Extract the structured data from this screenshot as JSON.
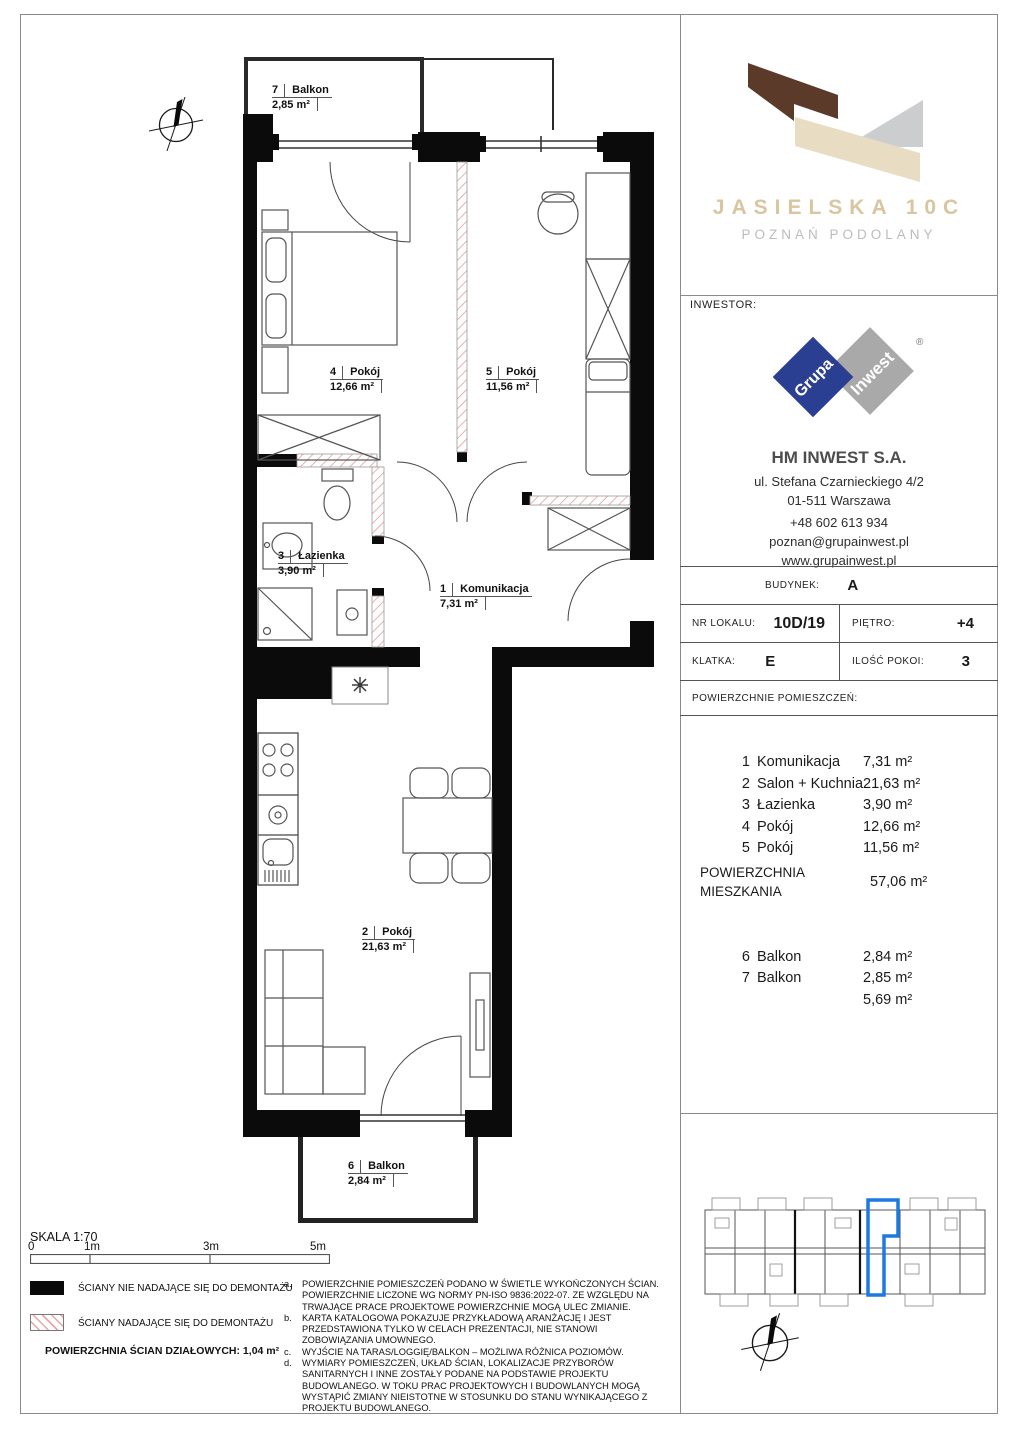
{
  "project": {
    "title": "JASIELSKA 10C",
    "subtitle": "POZNAŃ PODOLANY",
    "colors": {
      "brown": "#5b3a29",
      "beige": "#e8dcc3",
      "gray": "#cccdce",
      "title_beige": "#d9c6a0",
      "highlight_blue": "#1b79e0",
      "hatch_red": "#e89b9b"
    }
  },
  "investor": {
    "label": "INWESTOR:",
    "logo_word_left": "Grupa",
    "logo_word_right": "Inwest",
    "reg_mark": "®",
    "name": "HM INWEST S.A.",
    "address_line1": "ul. Stefana Czarnieckiego 4/2",
    "address_line2": "01-511 Warszawa",
    "phone": "+48 602 613 934",
    "email": "poznan@grupainwest.pl",
    "website": "www.grupainwest.pl"
  },
  "unit_info": {
    "budynek_label": "BUDYNEK:",
    "budynek": "A",
    "nr_lokalu_label": "NR LOKALU:",
    "nr_lokalu": "10D/19",
    "pietro_label": "PIĘTRO:",
    "pietro": "+4",
    "klatka_label": "KLATKA:",
    "klatka": "E",
    "ilosc_pokoi_label": "ILOŚĆ POKOI:",
    "ilosc_pokoi": "3",
    "powierzchnie_label": "POWIERZCHNIE POMIESZCZEŃ:"
  },
  "rooms": [
    {
      "num": "1",
      "name": "Komunikacja",
      "area": "7,31 m²"
    },
    {
      "num": "2",
      "name": "Salon + Kuchnia",
      "area": "21,63 m²"
    },
    {
      "num": "3",
      "name": "Łazienka",
      "area": "3,90 m²"
    },
    {
      "num": "4",
      "name": "Pokój",
      "area": "12,66 m²"
    },
    {
      "num": "5",
      "name": "Pokój",
      "area": "11,56 m²"
    }
  ],
  "total": {
    "label_line1": "POWIERZCHNIA",
    "label_line2": "MIESZKANIA",
    "area": "57,06 m²"
  },
  "balconies": [
    {
      "num": "6",
      "name": "Balkon",
      "area": "2,84 m²"
    },
    {
      "num": "7",
      "name": "Balkon",
      "area": "2,85 m²"
    }
  ],
  "balconies_sum": "5,69 m²",
  "plan": {
    "balkon7": {
      "num": "7",
      "name": "Balkon",
      "area": "2,85 m²"
    },
    "pokoj4": {
      "num": "4",
      "name": "Pokój",
      "area": "12,66 m²"
    },
    "pokoj5": {
      "num": "5",
      "name": "Pokój",
      "area": "11,56 m²"
    },
    "lazienka": {
      "num": "3",
      "name": "Łazienka",
      "area": "3,90 m²"
    },
    "komunikacja": {
      "num": "1",
      "name": "Komunikacja",
      "area": "7,31 m²"
    },
    "salon": {
      "num": "2",
      "name": "Pokój",
      "area": "21,63 m²"
    },
    "balkon6": {
      "num": "6",
      "name": "Balkon",
      "area": "2,84 m²"
    }
  },
  "scale": {
    "label": "SKALA 1:70",
    "t0": "0",
    "t1": "1m",
    "t3": "3m",
    "t5": "5m"
  },
  "legend": {
    "solid_label": "ŚCIANY NIE NADAJĄCE SIĘ DO DEMONTAŻU",
    "hatch_label": "ŚCIANY NADAJĄCE SIĘ DO DEMONTAŻU",
    "partition_label": "POWIERZCHNIA ŚCIAN DZIAŁOWYCH: 1,04 m²"
  },
  "notes": [
    {
      "letter": "a.",
      "text": "POWIERZCHNIE POMIESZCZEŃ PODANO W ŚWIETLE WYKOŃCZONYCH ŚCIAN. POWIERZCHNIE LICZONE WG NORMY PN-ISO 9836:2022-07. ZE WZGLĘDU NA TRWAJĄCE PRACE PROJEKTOWE POWIERZCHNIE MOGĄ ULEC ZMIANIE."
    },
    {
      "letter": "b.",
      "text": "KARTA KATALOGOWA POKAZUJE PRZYKŁADOWĄ ARANŻACJĘ I JEST PRZEDSTAWIONA TYLKO W CELACH PREZENTACJI, NIE STANOWI ZOBOWIĄZANIA UMOWNEGO."
    },
    {
      "letter": "c.",
      "text": "WYJŚCIE NA TARAS/LOGGIĘ/BALKON – MOŻLIWA RÓŻNICA POZIOMÓW."
    },
    {
      "letter": "d.",
      "text": "WYMIARY POMIESZCZEŃ, UKŁAD ŚCIAN, LOKALIZACJE PRZYBORÓW SANITARNYCH I INNE ZOSTAŁY PODANE NA PODSTAWIE PROJEKTU BUDOWLANEGO. W TOKU PRAC PROJEKTOWYCH I BUDOWLANYCH MOGĄ WYSTĄPIĆ ZMIANY NIEISTOTNE W STOSUNKU DO STANU WYNIKAJĄCEGO Z PROJEKTU BUDOWLANEGO."
    }
  ]
}
